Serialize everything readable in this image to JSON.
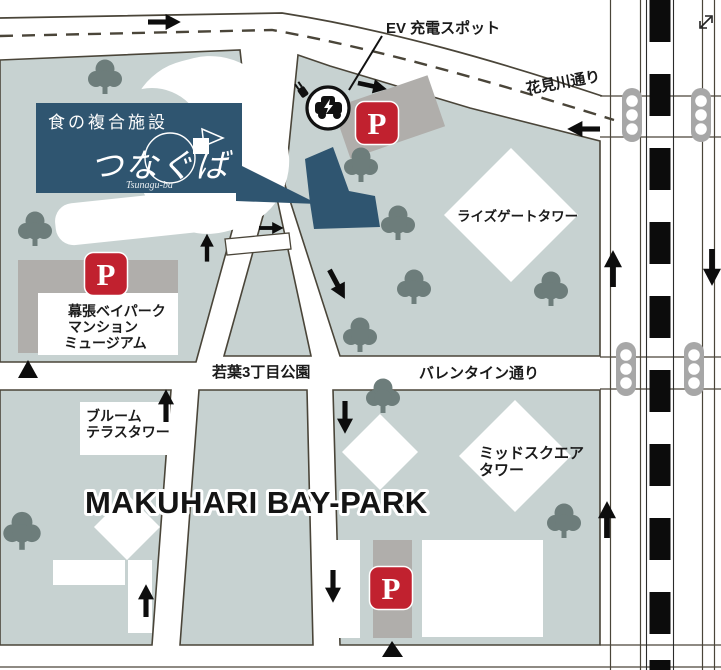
{
  "logo": {
    "category": "食の複合施設",
    "name": "つなぐば",
    "romaji": "Tsunagu-ba"
  },
  "labels": {
    "ev_spot": "EV 充電スポット",
    "hanamigawa_st": "花見川通り",
    "wakaba_park": "若葉3丁目公園",
    "valentine_st": "バレンタイン通り",
    "rise_gate_tower": "ライズゲートタワー",
    "museum_l1": "幕張ベイパーク",
    "museum_l2": "マンション",
    "museum_l3": "ミュージアム",
    "bloom_l1": "ブルーム",
    "bloom_l2": "テラスタワー",
    "midsquare_l1": "ミッドスクエア",
    "midsquare_l2": "タワー",
    "area_title": "MAKUHARI BAY-PARK",
    "parking": "P"
  },
  "colors": {
    "land": "#c7d2d1",
    "navy": "#2f5570",
    "parking_red": "#c1212f",
    "parking_gray": "#b0aeab",
    "tree": "#6d7d7b",
    "road_line": "#4a4539"
  }
}
